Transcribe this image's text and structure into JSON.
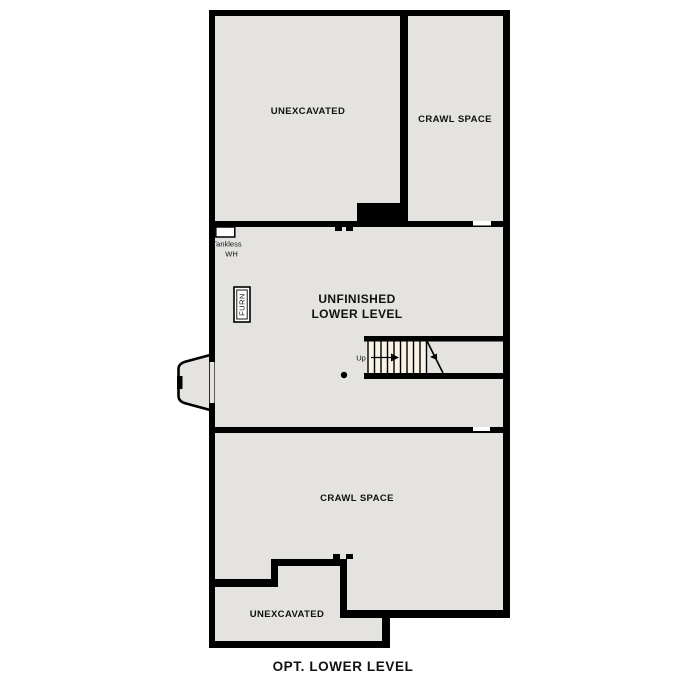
{
  "page": {
    "caption": "OPT. LOWER LEVEL"
  },
  "colors": {
    "background": "#ffffff",
    "wall": "#000000",
    "room_fill": "#e4e3e0",
    "stair_fill": "#f8f2e7",
    "text": "#111111"
  },
  "floorplan": {
    "rooms": {
      "upper_unexcavated": {
        "label": "UNEXCAVATED"
      },
      "upper_crawl_space": {
        "label": "CRAWL SPACE"
      },
      "lower_level": {
        "label_line1": "UNFINISHED",
        "label_line2": "LOWER LEVEL"
      },
      "lower_crawl_space": {
        "label": "CRAWL SPACE"
      },
      "bottom_unexcavated": {
        "label": "UNEXCAVATED"
      }
    },
    "fixtures": {
      "tankless_wh": {
        "label_line1": "Tankless",
        "label_line2": "WH"
      },
      "furnace": {
        "label": "FURN"
      },
      "stairs": {
        "direction_label": "Up"
      }
    }
  }
}
